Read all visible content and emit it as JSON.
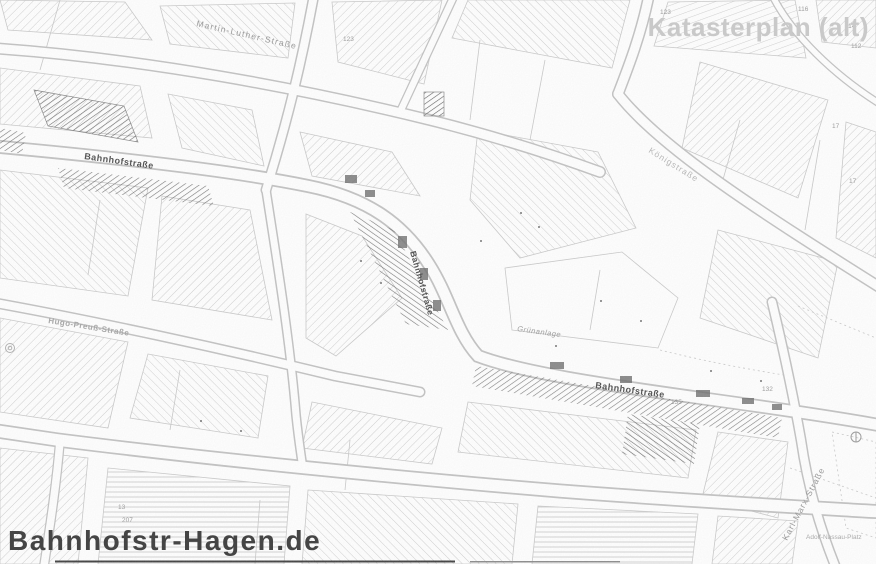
{
  "watermarks": {
    "top_right": "Katasterplan (alt)",
    "bottom_left": "Bahnhofstr-Hagen.de"
  },
  "map_labels": [
    {
      "name": "street-label-martin-luther-strasse",
      "text": "Martin-Luther-Straße",
      "x": 196,
      "y": 26,
      "rot": 13,
      "size": 8.5,
      "color": "#9a9a9a",
      "weight": "normal",
      "spacing": 1.2
    },
    {
      "name": "street-label-bahnhofstrasse-west",
      "text": "Bahnhofstraße",
      "x": 84,
      "y": 159,
      "rot": 8,
      "size": 9,
      "color": "#565656",
      "weight": "bold",
      "spacing": 0.5
    },
    {
      "name": "street-label-bahnhofstrasse-mid",
      "text": "Bahnhofstraße",
      "x": 410,
      "y": 252,
      "rot": 74,
      "size": 8.5,
      "color": "#565656",
      "weight": "bold",
      "spacing": 0.5
    },
    {
      "name": "street-label-bahnhofstrasse-east",
      "text": "Bahnhofstraße",
      "x": 595,
      "y": 388,
      "rot": 8,
      "size": 9,
      "color": "#565656",
      "weight": "bold",
      "spacing": 0.5
    },
    {
      "name": "street-label-hugo-preuss-strasse",
      "text": "Hugo-Preuß-Straße",
      "x": 48,
      "y": 323,
      "rot": 9,
      "size": 8,
      "color": "#a8a8a8",
      "weight": "bold",
      "spacing": 0.5
    },
    {
      "name": "street-label-koenigstrasse",
      "text": "Königstraße",
      "x": 648,
      "y": 152,
      "rot": 32,
      "size": 8.5,
      "color": "#b8b8b8",
      "weight": "normal",
      "spacing": 1
    },
    {
      "name": "street-label-karl-marx-strasse",
      "text": "Karl-Marx-Straße",
      "x": 787,
      "y": 541,
      "rot": -62,
      "size": 8.5,
      "color": "#9a9a9a",
      "weight": "normal",
      "spacing": 1
    },
    {
      "name": "place-label-adolf-nassau-platz",
      "text": "Adolf-Nassau-Platz",
      "x": 806,
      "y": 539,
      "rot": 0,
      "size": 6.5,
      "color": "#ababab",
      "weight": "normal",
      "spacing": 0
    },
    {
      "name": "area-label-gruenanlage",
      "text": "Grünanlage",
      "x": 517,
      "y": 331,
      "rot": 8,
      "size": 7.5,
      "color": "#9e9e9e",
      "weight": "normal",
      "style": "italic",
      "spacing": 0.5
    }
  ],
  "parcel_numbers": [
    {
      "text": "123",
      "x": 343,
      "y": 41
    },
    {
      "text": "123",
      "x": 660,
      "y": 14
    },
    {
      "text": "116",
      "x": 798,
      "y": 11
    },
    {
      "text": "114",
      "x": 845,
      "y": 28
    },
    {
      "text": "112",
      "x": 851,
      "y": 48
    },
    {
      "text": "17",
      "x": 832,
      "y": 128
    },
    {
      "text": "17",
      "x": 849,
      "y": 183
    },
    {
      "text": "132",
      "x": 762,
      "y": 391
    },
    {
      "text": "135",
      "x": 671,
      "y": 404
    },
    {
      "text": "207",
      "x": 122,
      "y": 522
    },
    {
      "text": "13",
      "x": 118,
      "y": 509
    }
  ],
  "colors": {
    "background": "#ffffff",
    "linework": "#c6c6c6",
    "hatch": "#d0d0d0",
    "dark_marks": "#555555",
    "watermark_light": "#c9c9c9",
    "watermark_dark": "#454545"
  }
}
